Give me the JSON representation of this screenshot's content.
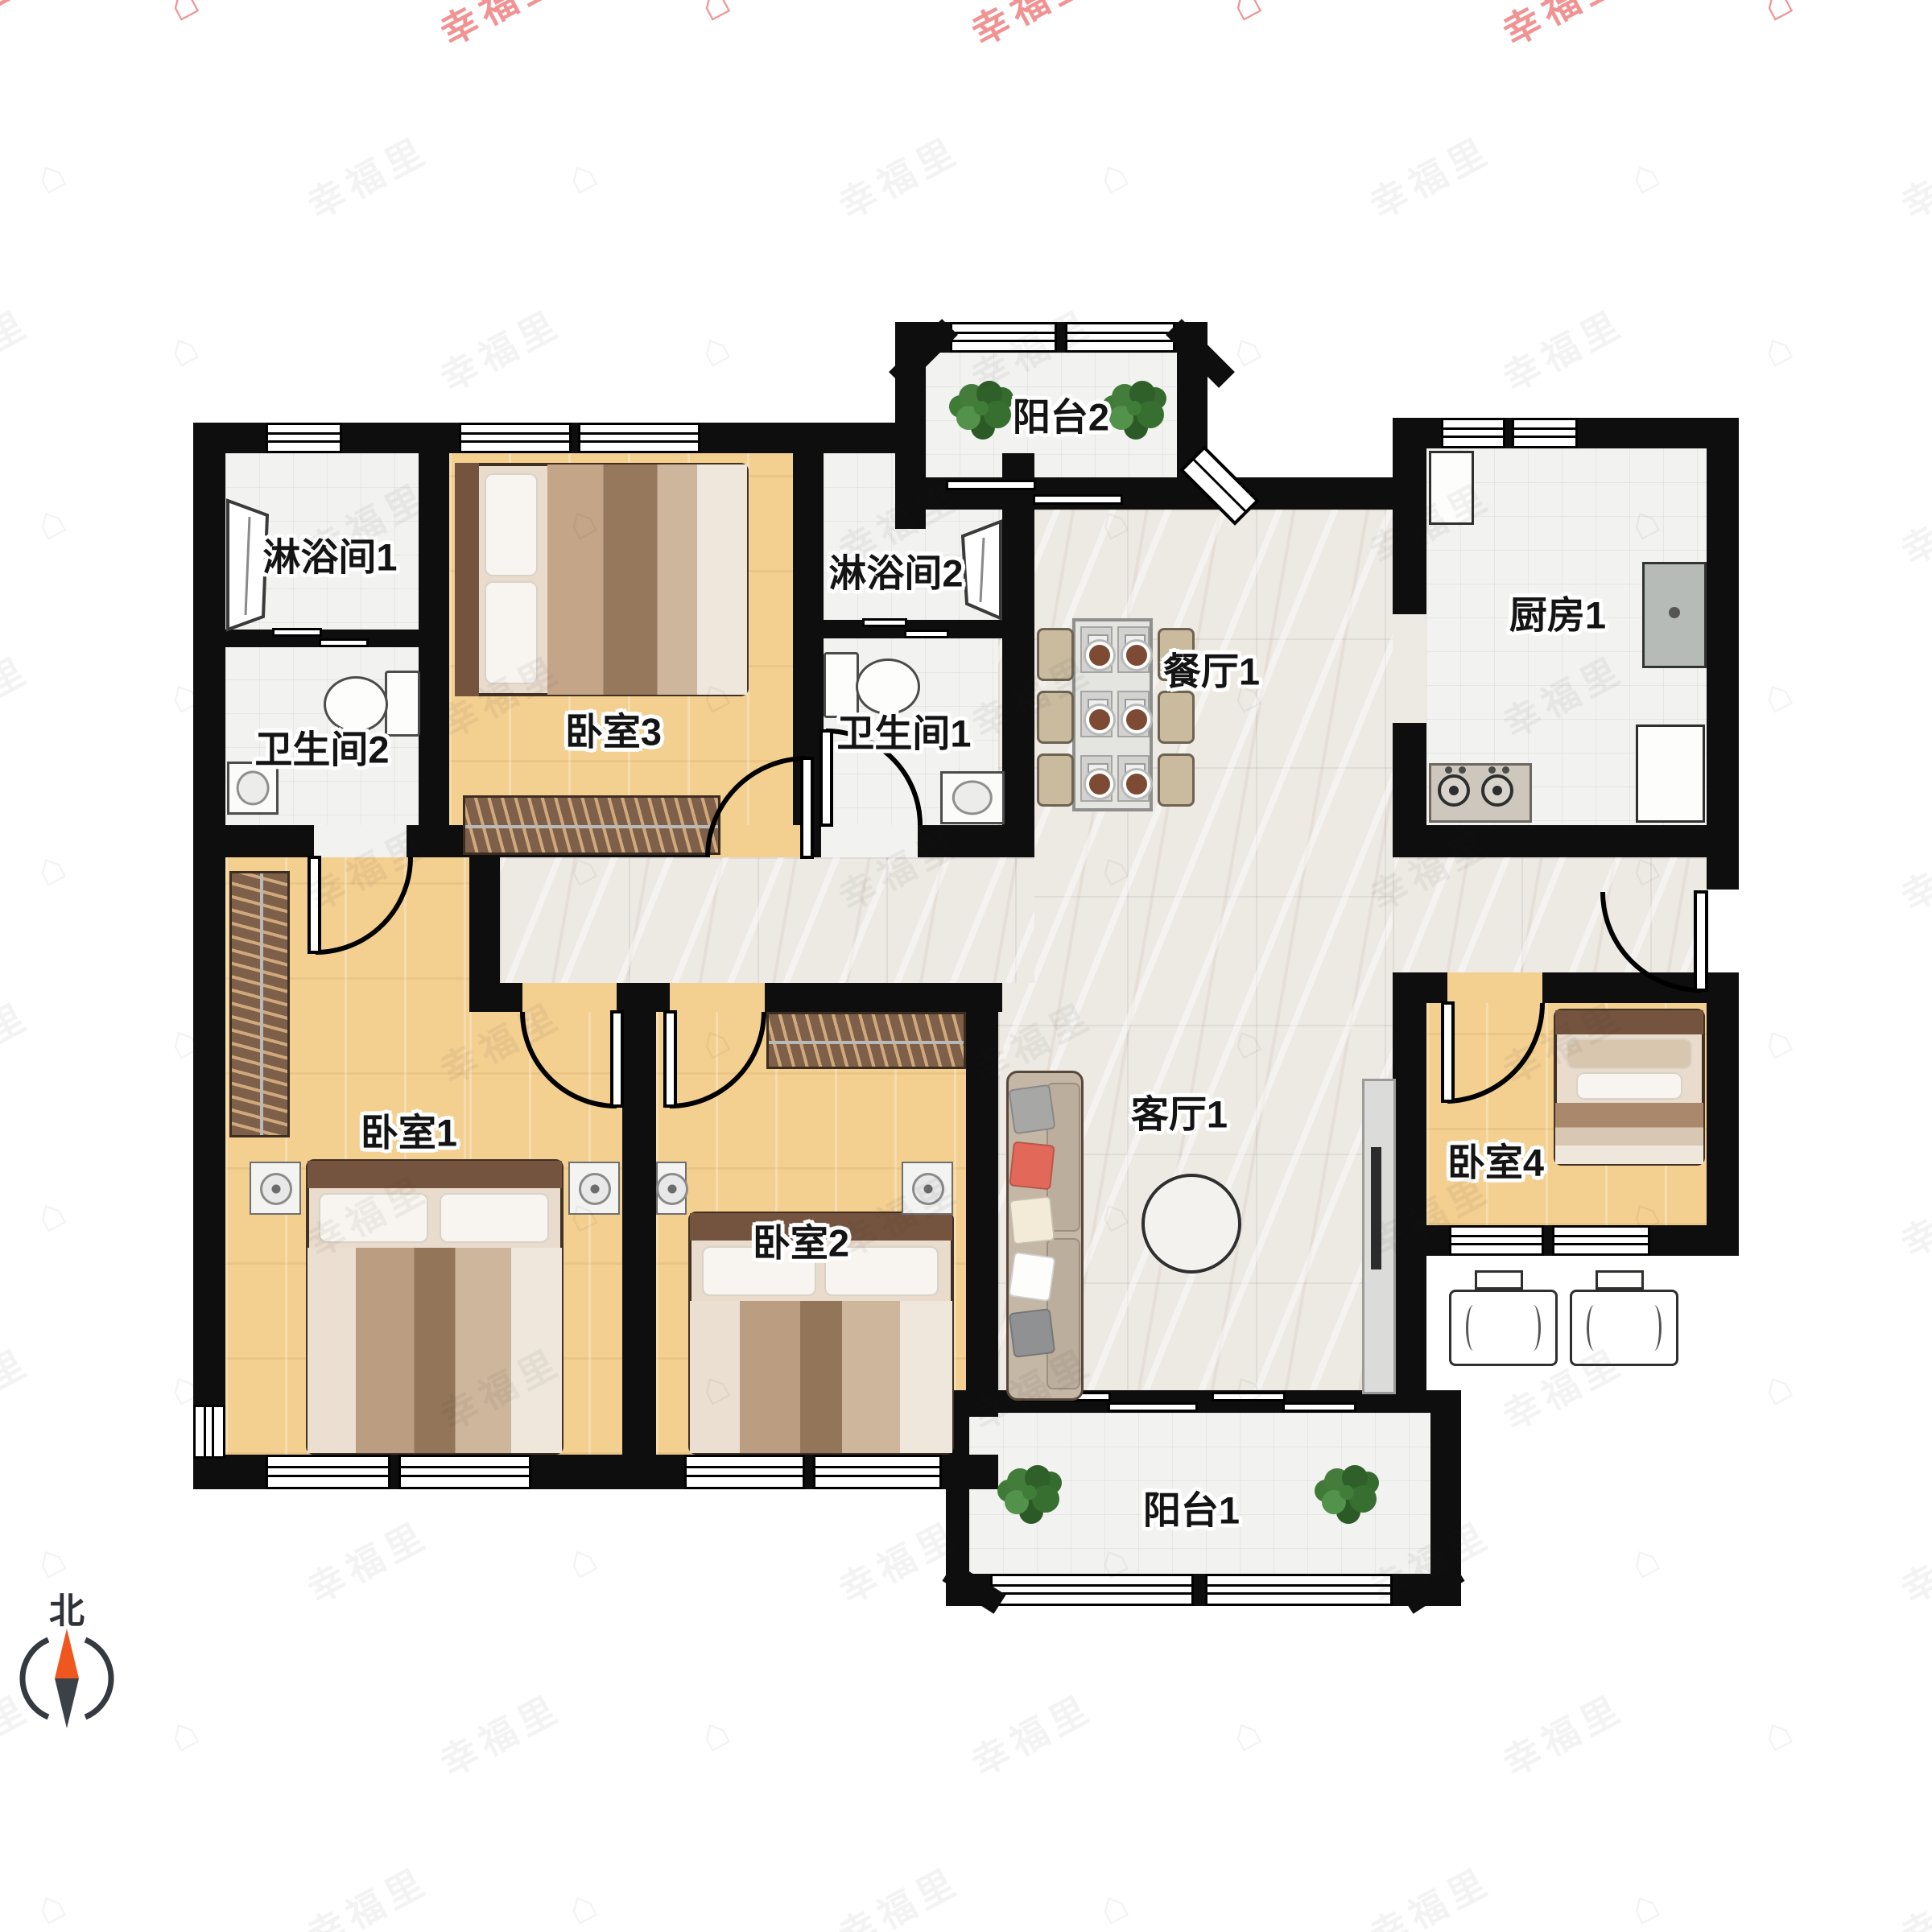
{
  "watermark": {
    "text": "幸福里",
    "icon": "house-icon"
  },
  "compass": {
    "north_label": "北",
    "needle_north_color": "#f0571f",
    "needle_south_color": "#3b4147"
  },
  "palette": {
    "wall": "#0e0e0e",
    "wood_floor": "#f3cf90",
    "tile_floor": "#f2f2f0",
    "marble_floor": "#ede9e3",
    "watermark_red": "#ee7878"
  },
  "rooms": [
    {
      "id": "shower-1",
      "label": "淋浴间1"
    },
    {
      "id": "toilet-2",
      "label": "卫生间2"
    },
    {
      "id": "bedroom-3",
      "label": "卧室3"
    },
    {
      "id": "shower-2",
      "label": "淋浴间2"
    },
    {
      "id": "toilet-1",
      "label": "卫生间1"
    },
    {
      "id": "balcony-2",
      "label": "阳台2"
    },
    {
      "id": "dining-1",
      "label": "餐厅1"
    },
    {
      "id": "kitchen-1",
      "label": "厨房1"
    },
    {
      "id": "bedroom-1",
      "label": "卧室1"
    },
    {
      "id": "bedroom-2",
      "label": "卧室2"
    },
    {
      "id": "living-1",
      "label": "客厅1"
    },
    {
      "id": "bedroom-4",
      "label": "卧室4"
    },
    {
      "id": "balcony-1",
      "label": "阳台1"
    }
  ],
  "furniture": [
    "double-bed",
    "single-bed",
    "wardrobe",
    "nightstand",
    "sofa",
    "round-tea-table",
    "tv-console",
    "dining-table",
    "dining-chair",
    "plant",
    "toilet",
    "wash-basin",
    "shower-stall",
    "kitchen-sink",
    "gas-stove",
    "air-conditioner-unit"
  ]
}
